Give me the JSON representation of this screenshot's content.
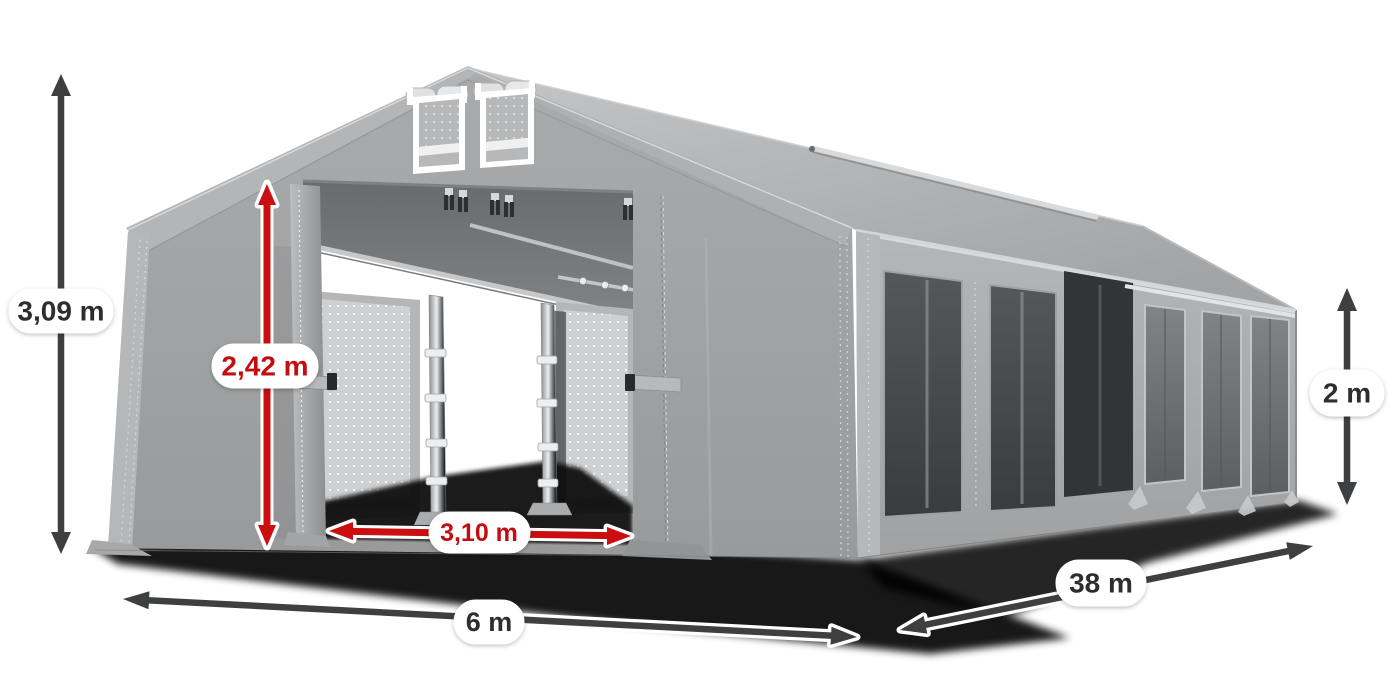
{
  "meta": {
    "description": "Grey PVC storage tent hall shown in 3/4 perspective with open front entrance, gable ventilation windows, mesh side windows and six dimension arrows"
  },
  "colors": {
    "background": "#ffffff",
    "accent_red": "#cb0e10",
    "label_red_text": "#c40d10",
    "dimension_dark": "#3e3f41",
    "label_pill": "#ffffff",
    "tent_fabric": "#a8aaac",
    "side_window_dark": "#46484a",
    "ground_shadow": "#000000"
  },
  "dimensions": {
    "total_height": {
      "label": "3,09 m",
      "style": "dark"
    },
    "door_height": {
      "label": "2,42 m",
      "style": "red"
    },
    "door_width": {
      "label": "3,10 m",
      "style": "red"
    },
    "front_width": {
      "label": "6 m",
      "style": "dark"
    },
    "side_length": {
      "label": "38 m",
      "style": "dark"
    },
    "wall_height": {
      "label": "2 m",
      "style": "dark"
    }
  }
}
